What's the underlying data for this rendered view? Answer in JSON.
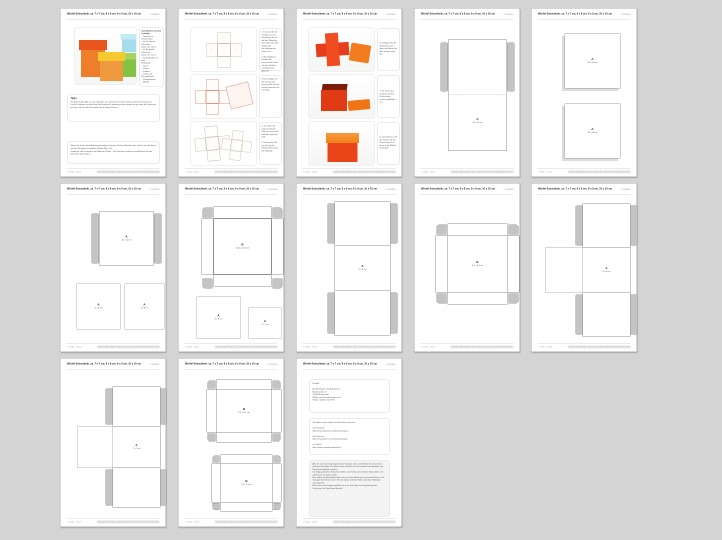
{
  "window": {
    "background": "#d4d4d4"
  },
  "header": {
    "title": "Würfel-Schachteln, ca. 7 x 7 cm, 8 x 8 cm, 9 x 9 cm, 10 x 10 cm",
    "date": "© 05/2010"
  },
  "footer": {
    "left": "© 2010 – 2013",
    "right": "www.bastelvorlagen-zum-ausdrucken.net/schachteln/wuerfel-schachteln.html"
  },
  "p1": {
    "materials": {
      "title": "Zum Basteln werden benötigt:",
      "items": "– Tonkarton in Wunschfarbe\n– für die kleinste Schachtel\n  mind. 16 x 16 cm\n– für die größte Schachtel\n  mind. 22 x 22 cm\n– Klebstoff oder ein paar\n  Klebepads\n– Lineal\n– Schere\n– Falzbein\n– Cutter und Schneidelineal\n– Schneidematte\n– Bleistift"
    },
    "tips": {
      "title": "Tipps:",
      "text": "Für jede Größe gibt es zwei Vorlagen: ein Unterteil und einen etwas größeren Deckel. Die Deckel-Vorlagen sind mit dem Buchstaben B gekennzeichnet, damit sie gut über die Unterteile passen und sich die Schachteln leicht öffnen lassen."
    },
    "note": "Wenn Sie keine extra Anleitung benötigen, können Sie beim Ausdrucken einfach nur die Seiten mit den Vorlagen auswählen (Seiten 4 bis 12).\nGedruckt wird am besten auf dünnem Papier – die Vorlagen werden anschließend auf den Tonkarton übertragen."
  },
  "p2": {
    "step12": "1. Drucken Sie die Vorlage aus und übertragen Sie sie auf den Tonkarton. Schneiden Sie alles entlang der durchgezogenen Linien aus.\n\n2. Anschließend werden alle gestrichelten Linien mit dem Falzbein vorgefalzt und geknickt.",
    "step3": "3. Die Vorlagen für die Deckel sind etwas größer als die für die Unterteile (rot markiert).",
    "step45": "4. So sehen die zugeschnittenen Teile aus, wenn alle Falzlinien geknickt sind.\n\n5. Bestreichen Sie nun die grauen Klebelaschen dünn mit Klebstoff."
  },
  "p3": {
    "step6": "6. Schlagen Sie die Seitenteile nach oben und kleben Sie die Laschen innen fest.",
    "step7": "7. So sehen das Unterteil und der Deckel fertig zusammengeklebt aus.",
    "step8": "8. Zum Schluss wird der Deckel auf das Unterteil gesetzt – fertig ist die Würfel-Schachtel."
  },
  "p4": {
    "label": {
      "letter": "A",
      "size": "10 x 10 cm"
    }
  },
  "p5": {
    "top": {
      "letter": "A",
      "size": "10 x 10 cm"
    },
    "bottom": {
      "letter": "A",
      "size": "10 x 10 cm"
    }
  },
  "p6": {
    "top": {
      "letter": "A",
      "size": "10 x 10 cm"
    },
    "left": {
      "letter": "A",
      "size": "9 x 9 cm"
    },
    "right": {
      "letter": "A",
      "size": "9 x 9 cm"
    }
  },
  "p7": {
    "cross": {
      "letter": "B",
      "size": "10,4 x 10,4 cm"
    },
    "left": {
      "letter": "A",
      "size": "8 x 8 cm"
    },
    "right": {
      "letter": "A",
      "size": "7 x 7 cm"
    }
  },
  "p8": {
    "label": {
      "letter": "A",
      "size": "9 x 9 cm"
    }
  },
  "p9": {
    "label": {
      "letter": "B",
      "size": "9,4 x 9,4 cm"
    }
  },
  "p10": {
    "label": {
      "letter": "A",
      "size": "8 x 8 cm"
    }
  },
  "p11": {
    "label": {
      "letter": "A",
      "size": "7 x 7 cm"
    }
  },
  "p12": {
    "top": {
      "letter": "B",
      "size": "8,4 x 8,4 cm"
    },
    "bottom": {
      "letter": "B",
      "size": "7,4 x 7,4 cm"
    }
  },
  "p13": {
    "contact": "Kontakt:\n\nBastelvorlagen zum Ausdrucken\nMusterstraße 12\n12345 Musterstadt\nE-Mail: post@bastelvorlagen.net\nTelefon: 01234 / 56 78 90",
    "links": "Sie finden meine Seiten auch bei diesen Diensten:\n\nauf Facebook:\nhttps://www.facebook.com/bastelvorlagen\n\nauf Pinterest:\nhttps://www.pinterest.com/bastelvorlagen\n\nauf Twitter:\nhttps://twitter.com/bastelvorlagen",
    "terms": "Alle hier zum Download angebotenen Vorlagen sind ausschließlich für den privaten Gebrauch bestimmt. Sie dürfen weder verkauft noch auf anderen Internetseiten zum Download angeboten werden.\nDie fertig gebastelten Schachteln dürfen verschenkt und in kleinen Stückzahlen z. B. auf Basaren verkauft werden.\nBitte haben Sie Verständnis dafür, dass ich keine Haftung für eventuelle Fehler in den Vorlagen übernehmen kann. Für die Inhalte verlinkter Seiten sind deren Betreiber verantwortlich.\nWenn Ihnen die Vorlagen gefallen, freue ich mich über eine Empfehlung oder Verlinkung. Viel Spaß beim Basteln!"
  }
}
